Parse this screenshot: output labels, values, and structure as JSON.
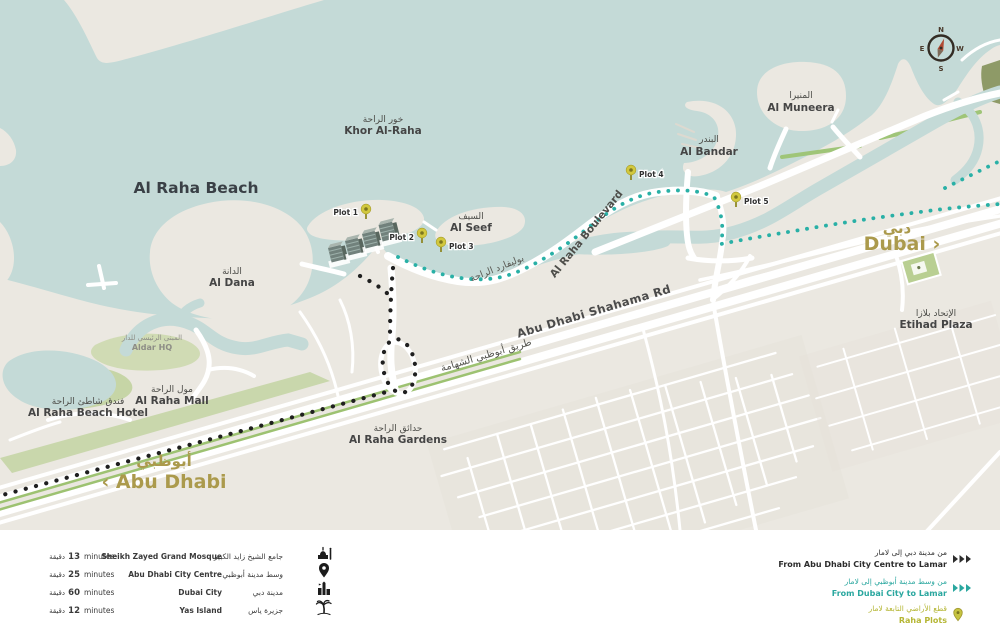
{
  "areas": {
    "khor": {
      "ar": "خور الراحة",
      "en": "Khor Al-Raha"
    },
    "beach": {
      "en": "Al Raha Beach"
    },
    "muneera": {
      "ar": "المنيرا",
      "en": "Al Muneera"
    },
    "bandar": {
      "ar": "البندر",
      "en": "Al Bandar"
    },
    "seef": {
      "ar": "السيف",
      "en": "Al Seef"
    },
    "dana": {
      "ar": "الدانة",
      "en": "Al Dana"
    },
    "mall": {
      "ar": "مول الراحة",
      "en": "Al Raha Mall"
    },
    "hotel": {
      "ar": "فندق شاطئ الراحة",
      "en": "Al Raha Beach Hotel"
    },
    "gardens": {
      "ar": "حدائق الراحة",
      "en": "Al Raha Gardens"
    },
    "etihad": {
      "ar": "الإتحاد بلازا",
      "en": "Etihad Plaza"
    },
    "aldar": {
      "ar": "المبنى الرئيسي للدار",
      "en": "Aldar HQ"
    }
  },
  "roads": {
    "shahama": {
      "en": "Abu Dhabi Shahama Rd",
      "ar": "طريق أبوظبي الشهامة"
    },
    "boulevard": {
      "en": "Al Raha Boulevard",
      "ar": "بوليفارد الراحة"
    }
  },
  "cities": {
    "dubai": {
      "ar": "دبي",
      "en": "Dubai ›"
    },
    "abu_dhabi": {
      "ar": "أبوظبي",
      "en": "‹ Abu Dhabi"
    }
  },
  "plots": [
    "Plot 1",
    "Plot 2",
    "Plot 3",
    "Plot 4",
    "Plot 5"
  ],
  "compass": {
    "n": "N",
    "e": "E",
    "w": "W",
    "s": "S"
  },
  "legend": {
    "destinations": [
      {
        "minutes_ar": "دقيقة",
        "minutes": "13",
        "minutes_label": "minutes",
        "en": "Sheikh Zayed Grand Mosque",
        "ar": "جامع الشيخ زايد الكبير",
        "icon": "mosque-icon"
      },
      {
        "minutes_ar": "دقيقة",
        "minutes": "25",
        "minutes_label": "minutes",
        "en": "Abu Dhabi City Centre",
        "ar": "وسط مدينة أبوظبي",
        "icon": "city-centre-pin-icon"
      },
      {
        "minutes_ar": "دقيقة",
        "minutes": "60",
        "minutes_label": "minutes",
        "en": "Dubai City",
        "ar": "مدينة دبي",
        "icon": "dubai-city-icon"
      },
      {
        "minutes_ar": "دقيقة",
        "minutes": "12",
        "minutes_label": "minutes",
        "en": "Yas Island",
        "ar": "جزيرة ياس",
        "icon": "palm-island-icon"
      }
    ],
    "routes": [
      {
        "ar": "من مدينة دبي إلى لامار",
        "en": "From Abu Dhabi City Centre to Lamar",
        "color": "#2d2d2d",
        "marker": "arrows"
      },
      {
        "ar": "من وسط مدينة أبوظبي إلى لامار",
        "en": "From Dubai City to Lamar",
        "color": "#2aa79f",
        "marker": "arrows"
      },
      {
        "ar": "قطع الأراضي التابعة لامار",
        "en": "Raha Plots",
        "color": "#b5b634",
        "marker": "pin"
      }
    ]
  },
  "colors": {
    "water": "#c4dad7",
    "land": "#ebe8e1",
    "road": "#ffffff",
    "green": "#c2d3a0",
    "gold": "#ab9a4c",
    "route_teal": "#29b0a6",
    "route_black": "#1f1f1f",
    "plot_pin": "#d2c83e"
  }
}
